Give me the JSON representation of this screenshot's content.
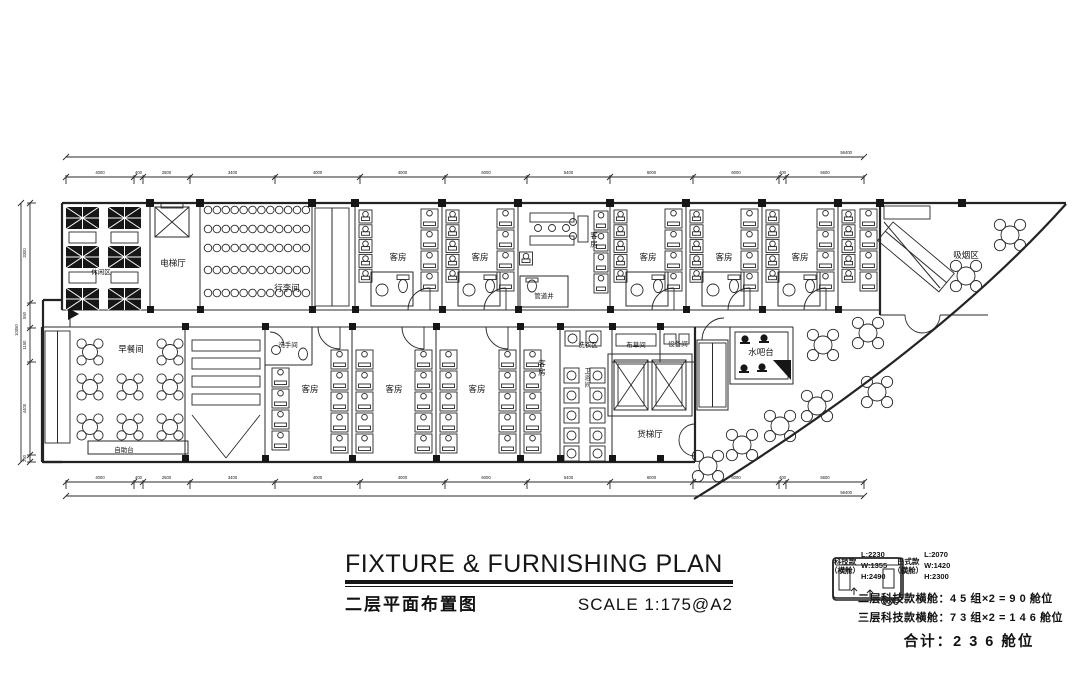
{
  "title": {
    "en": "FIXTURE  &  FURNISHING  PLAN",
    "cn": "二层平面布置图",
    "scale": "SCALE  1:175@A2"
  },
  "labels": {
    "leisure": "休闲区",
    "elevator_hall": "电梯厅",
    "luggage": "行李间",
    "guestroom": "客房",
    "pipe_shaft": "管道井",
    "smoking": "吸烟区",
    "breakfast": "早餐间",
    "buffet": "自助台",
    "washroom": "洗手间",
    "laundry": "洗衣区",
    "bath": "卫浴间",
    "linen": "布草间",
    "equipment": "设备间",
    "water_bar": "水吧台",
    "freight_elevator": "货梯厅"
  },
  "legend": {
    "pods": [
      {
        "name": "科技款",
        "variant": "（横舱）",
        "l": "L:2230",
        "w": "W:1355",
        "h": "H:2490"
      },
      {
        "name": "日式款",
        "variant": "（横舱）",
        "l": "L:2070",
        "w": "W:1420",
        "h": "H:2300"
      }
    ],
    "notes": [
      "二层科技款横舱：4 5 组×2 = 9 0 舱位",
      "三层科技款横舱：7 3 组×2 = 1 4 6 舱位"
    ],
    "total": "合计：2 3 6 舱位"
  },
  "dimensions": {
    "top": {
      "overall": "56400",
      "segments": [
        "4000",
        "400",
        "2500",
        "3400",
        "4000",
        "4000",
        "6000",
        "5400",
        "6000",
        "6000",
        "400",
        "5600"
      ]
    },
    "bottom": {
      "overall": "56400",
      "segments": [
        "4000",
        "400",
        "2500",
        "3400",
        "4000",
        "4000",
        "6000",
        "5400",
        "6000",
        "6000",
        "400",
        "5600"
      ]
    },
    "left": {
      "overall": "10050",
      "segments": [
        "3300",
        "550",
        "1150",
        "4400",
        "250"
      ]
    }
  }
}
